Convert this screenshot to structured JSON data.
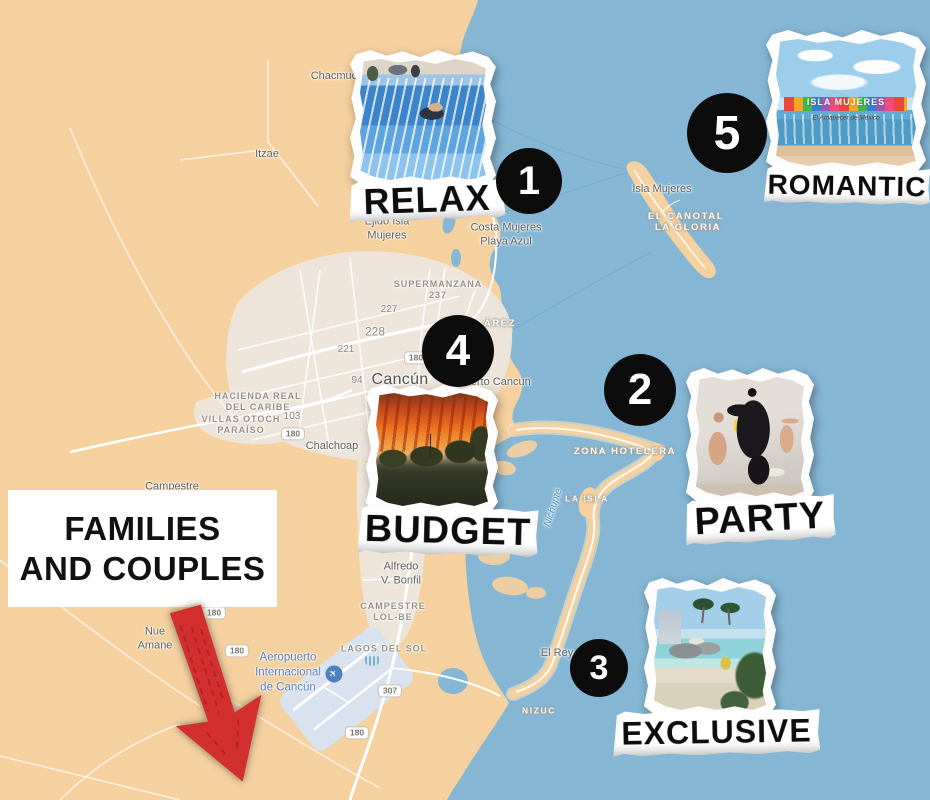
{
  "colors": {
    "water": "#85B7D4",
    "land": "#F5D1A0",
    "urban": "#EDE6DD",
    "airport_zone": "#D9E2EF",
    "marker_bg": "#0c0c0c",
    "marker_text": "#ffffff",
    "arrow_red": "#D32F2F",
    "callout_bg": "#ffffff",
    "callout_text": "#111111"
  },
  "callout": {
    "line1": "FAMILIES",
    "line2": "AND COUPLES"
  },
  "markers": {
    "m1": {
      "number": "1",
      "label": "RELAX"
    },
    "m2": {
      "number": "2",
      "label": "PARTY"
    },
    "m3": {
      "number": "3",
      "label": "EXCLUSIVE"
    },
    "m4": {
      "number": "4",
      "label": "BUDGET"
    },
    "m5": {
      "number": "5",
      "label": "ROMANTIC"
    }
  },
  "photos": {
    "relax": "flowrider-wave-pool-photo",
    "party": "gorilla-costume-party-photo",
    "exclusive": "resort-lagoon-pool-photo",
    "budget": "sunset-over-trees-photo",
    "romantic": "isla-mujeres-beach-sign-photo",
    "romantic_sign": "ISLA MUJERES",
    "romantic_caption": "El Amanecer de México"
  },
  "map": {
    "labels": {
      "chacmuch": "Chacmuch",
      "itzae": "Itzae",
      "ejido_isla_mujeres": "Ejido Isla\nMujeres",
      "costa_mujeres": "Costa Mujeres\nPlaya Azul",
      "isla_mujeres": "Isla Mujeres",
      "el_canotal": "EL CANOTAL",
      "la_gloria": "LA GLORIA",
      "supermanzana_237": "SUPERMANZANA\n237",
      "d227": "227",
      "d228": "228",
      "d221": "221",
      "d94": "94",
      "cancun": "Cancún",
      "puerto_cancun": "Puerto Cancun",
      "juarez_partial": "ÁREZ",
      "hacienda_real": "HACIENDA REAL\nDEL CARIBE",
      "villas_otoch": "VILLAS OTOCH\nPARAÍSO",
      "d103": "103",
      "chalchoap": "Chalchoap",
      "campestre_santa_maria": "Campestre\nSanta María",
      "alfredo_bonfil": "Alfredo\nV. Bonfil",
      "campestre_lolbe": "CAMPESTRE\nLOL-BE",
      "lagos_del_sol": "LAGOS DEL SOL",
      "nuevo_amanecer": "Nue\nAmane",
      "aeropuerto": "Aeropuerto\nInternacional\nde Cancún",
      "zona_hotelera": "ZONA HOTELERA",
      "la_isla": "LA ISLA",
      "nichupte": "Nichupté",
      "el_rey": "El Rey",
      "nizuc": "NIZUC"
    },
    "shields": {
      "s1": "180",
      "s2": "180",
      "s3": "180",
      "s4": "307",
      "s5": "180",
      "s6": "180"
    }
  }
}
